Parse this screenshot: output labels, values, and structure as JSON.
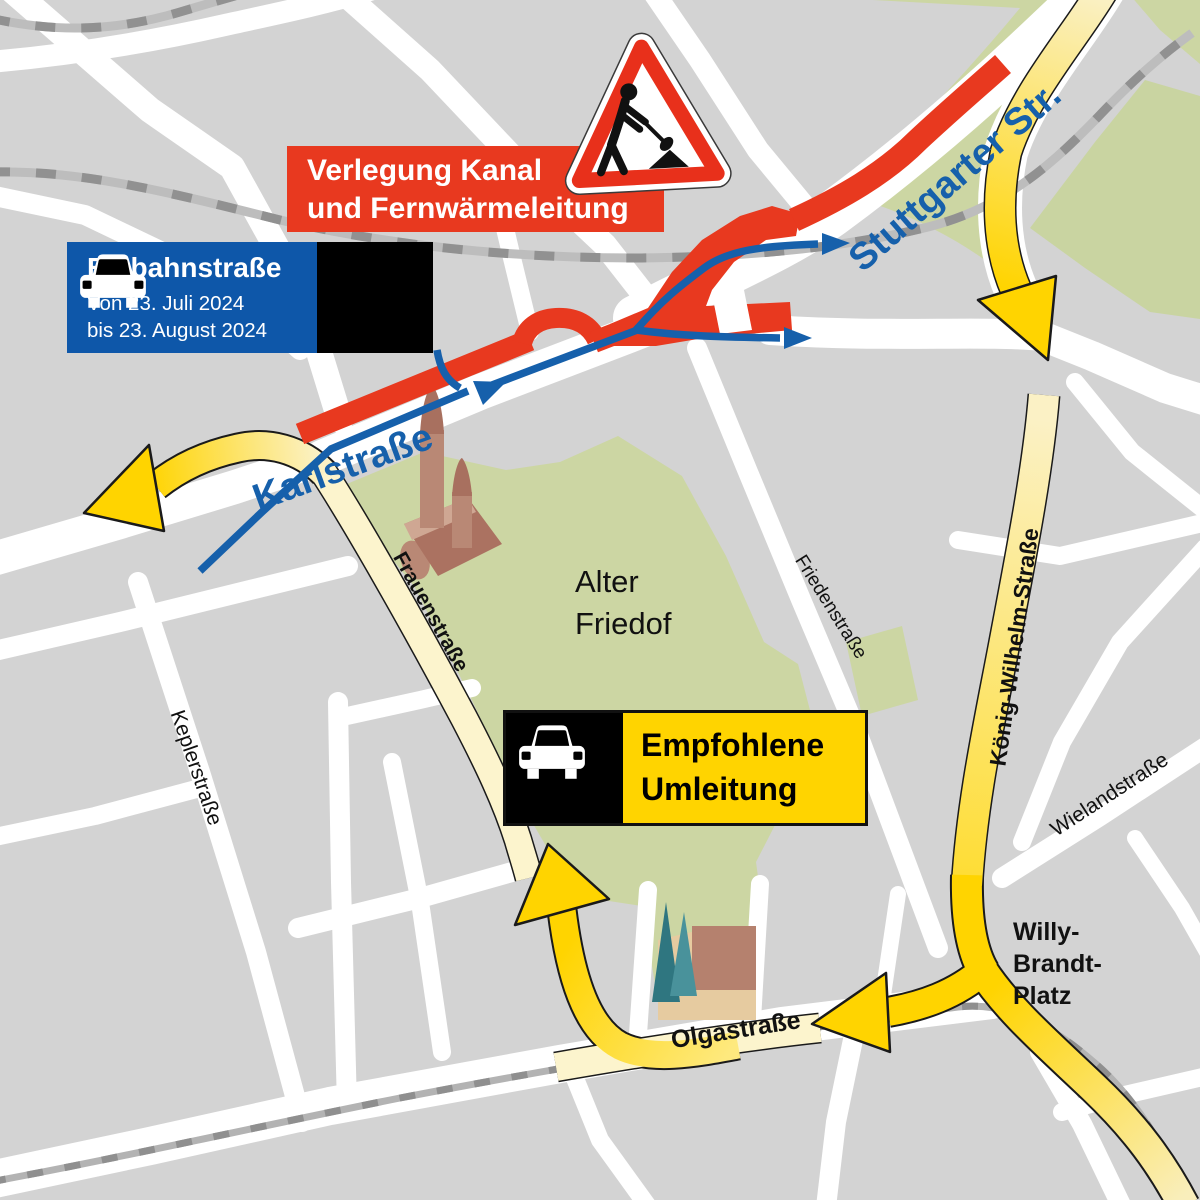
{
  "banners": {
    "roadworks": {
      "line1": "Verlegung Kanal",
      "line2": "und Fernwärmeleitung"
    },
    "oneway": {
      "title": "Einbahnstraße",
      "date1": "Von 23. Juli 2024",
      "date2": "bis 23. August 2024"
    },
    "detour": {
      "line1": "Empfohlene",
      "line2": "Umleitung"
    }
  },
  "labels": {
    "stuttgarter": "Stuttgarter Str.",
    "karlstrasse": "Karlstraße",
    "frauenstrasse": "Frauenstraße",
    "keplerstrasse": "Keplerstraße",
    "friedenstrasse": "Friedenstraße",
    "koenig_wilhelm": "König-Wilhelm-Straße",
    "wielandstrasse": "Wielandstraße",
    "olgastrasse": "Olgastraße",
    "willy1": "Willy-",
    "willy2": "Brandt-",
    "willy3": "Platz",
    "cemetery1": "Alter",
    "cemetery2": "Friedof"
  },
  "icons": {
    "car": "car-icon",
    "sign": "roadworks-triangle-sign"
  },
  "colors": {
    "construction_red": "#e8391f",
    "route_yellow": "#ffd400",
    "pale_road_yellow": "#fcf4cd",
    "oneway_banner_blue": "#0e57a9",
    "street_label_blue": "#1660ab",
    "park_green": "#ccd6a3",
    "map_gray": "#d3d3d3"
  }
}
